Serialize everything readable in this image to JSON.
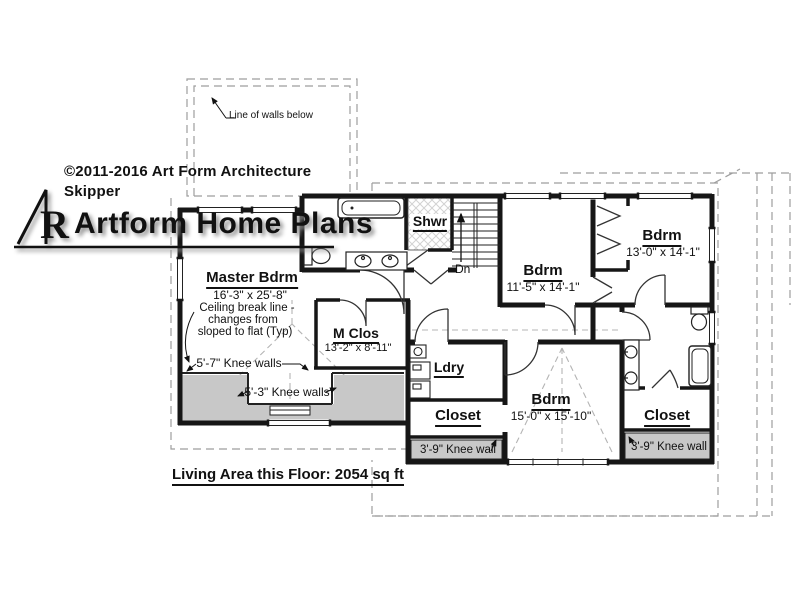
{
  "branding": {
    "copyright_line1": "©2011-2016 Art Form Architecture",
    "copyright_line2": "Skipper",
    "logo_text": "Artform Home Plans",
    "logo_monogram": "R"
  },
  "annotations": {
    "line_of_walls_below": "Line of walls below",
    "ceiling_break_line1": "Ceiling break line -",
    "ceiling_break_line2": "changes from",
    "ceiling_break_line3": "sloped to flat (Typ)",
    "knee_walls_57": "5'-7\" Knee walls",
    "knee_walls_53": "5'-3\" Knee walls",
    "knee_wall_39_left": "3'-9\" Knee wall",
    "knee_wall_39_right": "3'-9\" Knee wall",
    "stairs_direction": "Dn",
    "living_area": "Living Area this Floor: 2054 sq ft"
  },
  "rooms": {
    "master_bdrm": {
      "name": "Master Bdrm",
      "dims": "16'-3\" x 25'-8\""
    },
    "m_clos": {
      "name": "M Clos",
      "dims": "13'-2\" x 8'-11\""
    },
    "shwr": {
      "name": "Shwr"
    },
    "bdrm_middle": {
      "name": "Bdrm",
      "dims": "11'-5\" x 14'-1\""
    },
    "bdrm_top_right": {
      "name": "Bdrm",
      "dims": "13'-0\" x 14'-1\""
    },
    "bdrm_bottom": {
      "name": "Bdrm",
      "dims": "15'-0\" x 15'-10\""
    },
    "ldry": {
      "name": "Ldry"
    },
    "closet_left": {
      "name": "Closet"
    },
    "closet_right": {
      "name": "Closet"
    }
  },
  "colors": {
    "wall": "#161616",
    "knee_wall_fill": "#c8c8c8",
    "roof_dashed": "#9e9e9e",
    "ceiling_dashed": "#b4b4b4",
    "shadow": "#8f8f8f"
  }
}
